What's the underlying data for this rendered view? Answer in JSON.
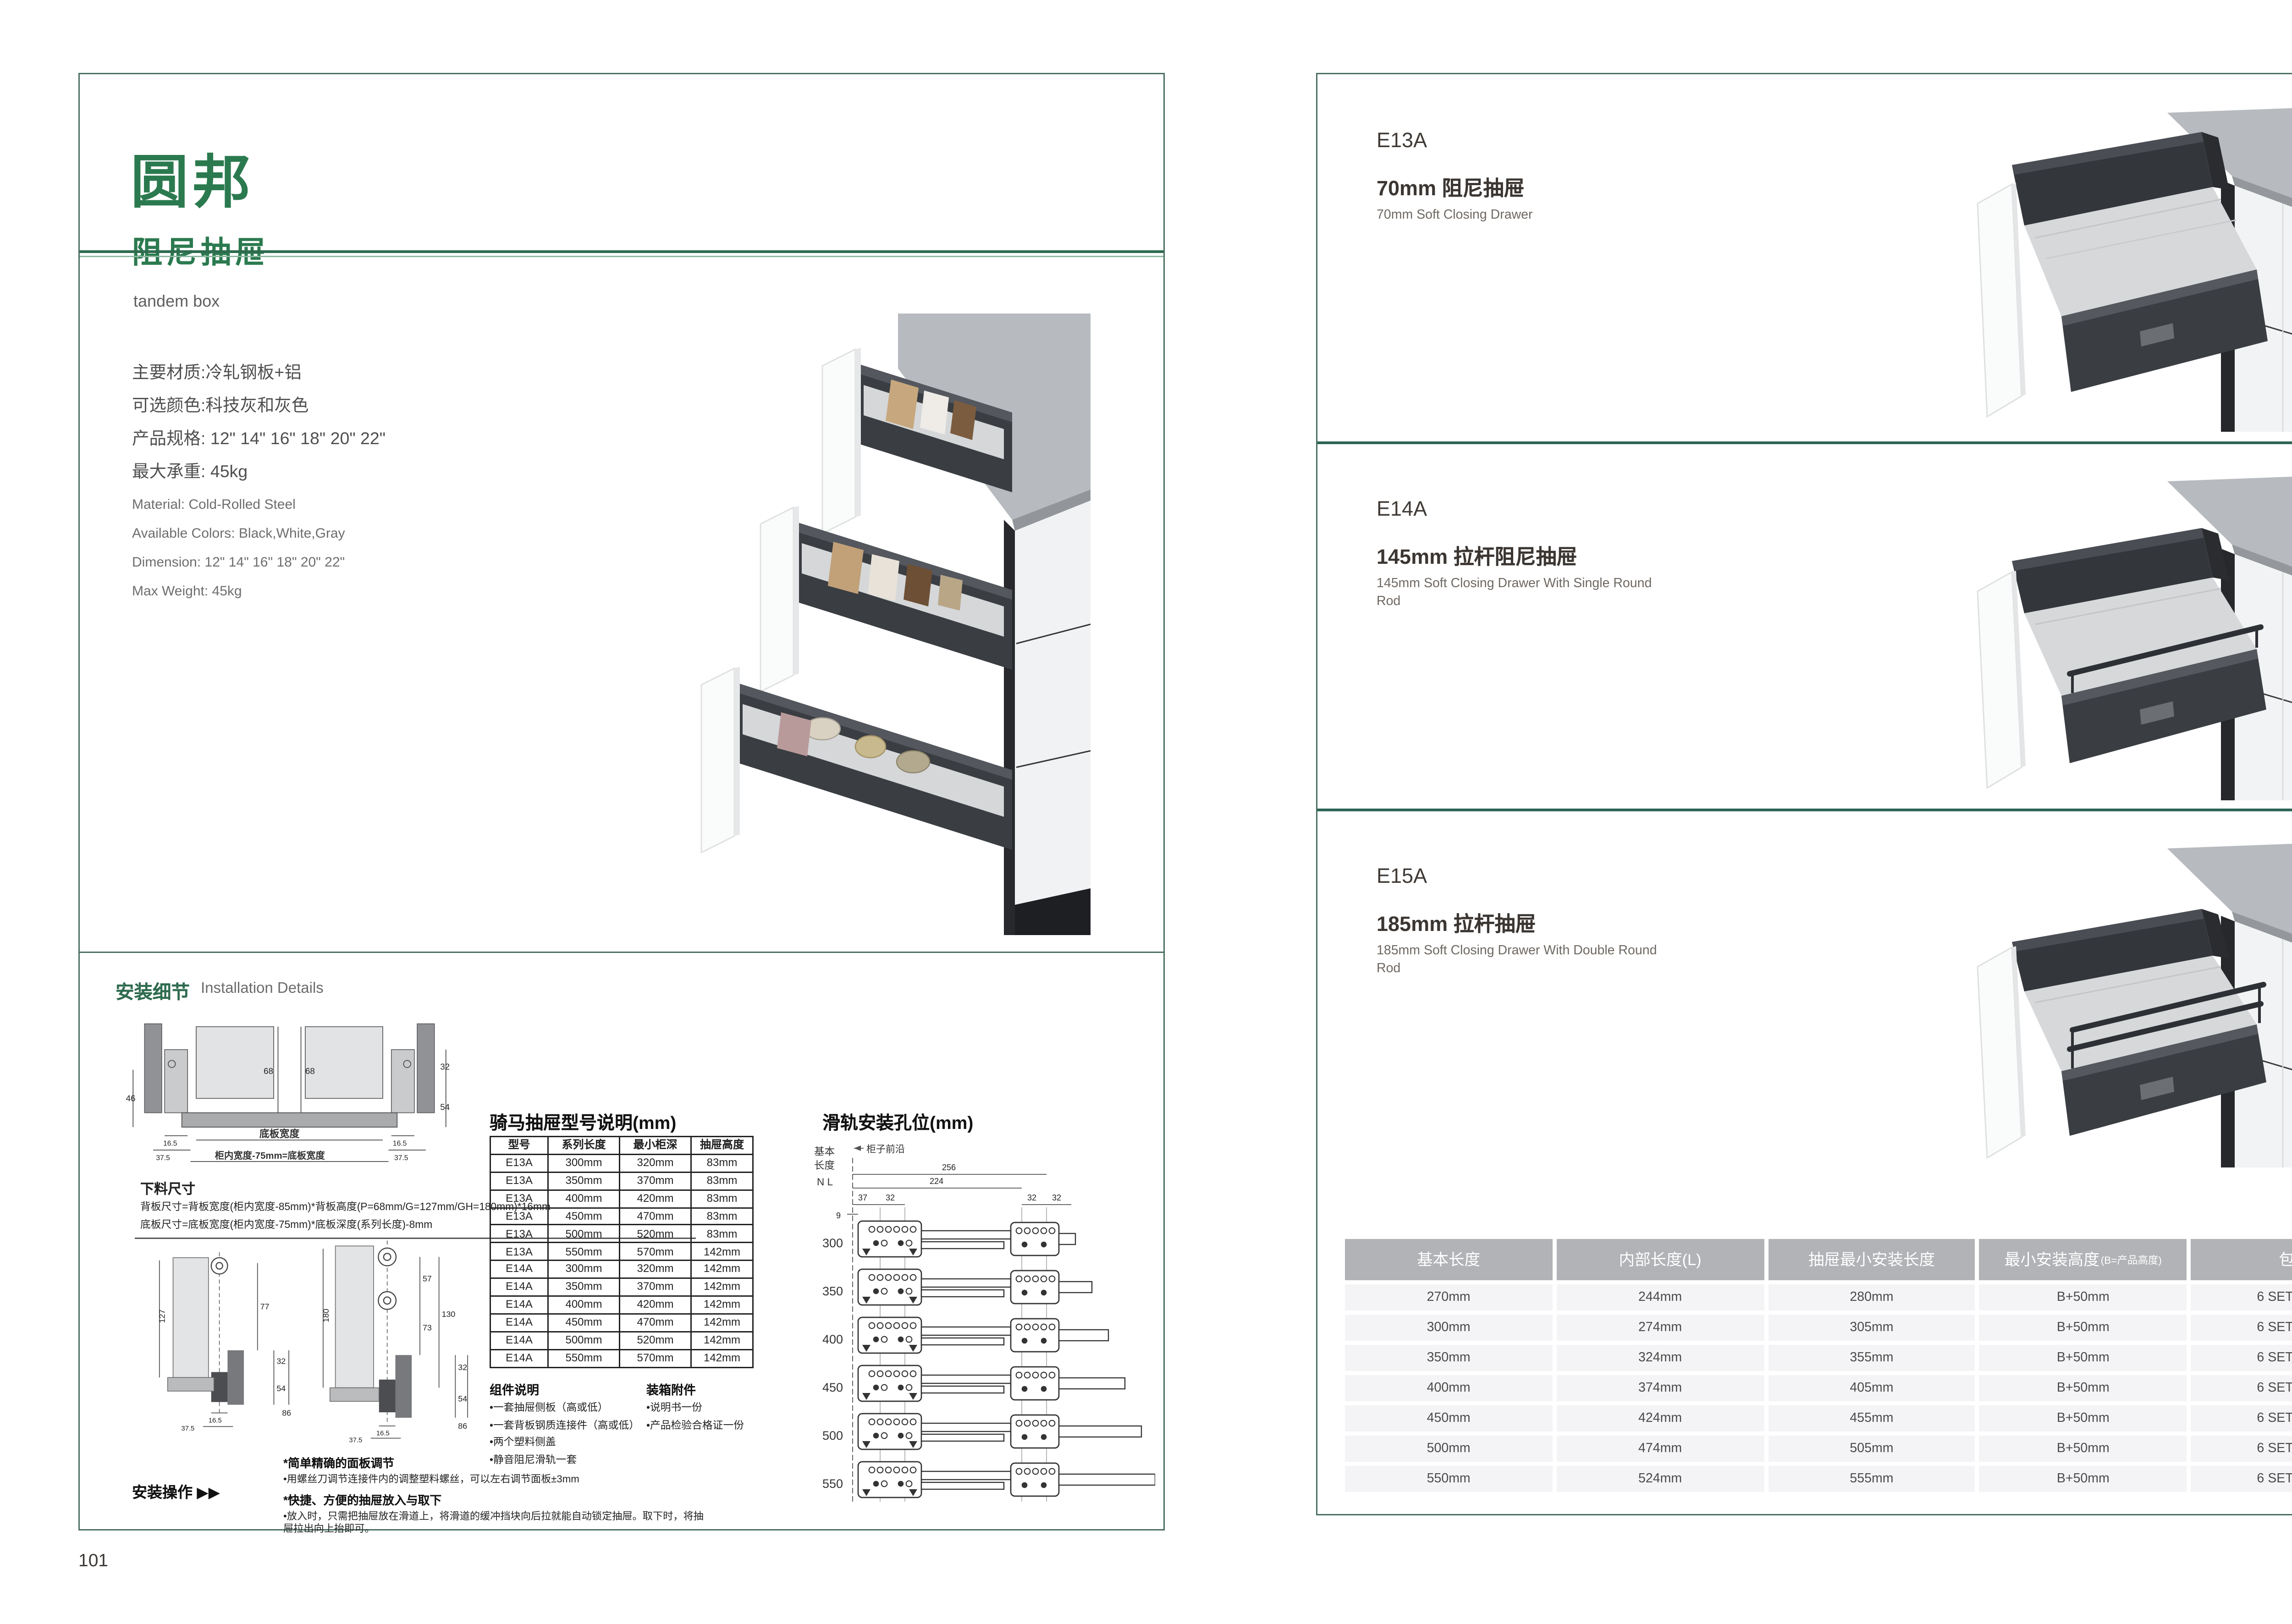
{
  "page": {
    "left_number": "101",
    "right_number": "102"
  },
  "left_page": {
    "brand": "圆邦",
    "subtitle_cn": "阻尼抽屉",
    "subtitle_en": "tandem box",
    "specs_cn": [
      "主要材质:冷轧钢板+铝",
      "可选颜色:科技灰和灰色",
      "产品规格: 12\" 14\" 16\" 18\" 20\" 22\"",
      "最大承重: 45kg"
    ],
    "specs_en": [
      "Material: Cold-Rolled Steel",
      "Available Colors: Black,White,Gray",
      "Dimension: 12\" 14\" 16\" 18\" 20\" 22\"",
      "Max Weight: 45kg"
    ],
    "install_title_cn": "安装细节",
    "install_title_en": "Installation Details",
    "cross_section": {
      "d68a": "68",
      "d68b": "68",
      "d46": "46",
      "d32": "32",
      "d54": "54",
      "d165l": "16.5",
      "d165r": "16.5",
      "d375l": "37.5",
      "d375r": "37.5",
      "label_width": "底板宽度",
      "label_formula": "柜内宽度-75mm=底板宽度"
    },
    "cutting": {
      "title": "下料尺寸",
      "formula1": "背板尺寸=背板宽度(柜内宽度-85mm)*背板高度(P=68mm/G=127mm/GH=180mm)*16mm",
      "formula2": "底板尺寸=底板宽度(柜内宽度-75mm)*底板深度(系列长度)-8mm"
    },
    "diagram_a": {
      "d127": "127",
      "d77": "77",
      "d32": "32",
      "d54": "54",
      "d86": "86",
      "d165": "16.5",
      "d375": "37.5"
    },
    "diagram_b": {
      "d180": "180",
      "d57": "57",
      "d73": "73",
      "d130": "130",
      "d32": "32",
      "d54": "54",
      "d86": "86",
      "d165": "16.5",
      "d375": "37.5"
    },
    "operation": {
      "label": "安装操作",
      "arrows": "▶▶",
      "note1_head": "*简单精确的面板调节",
      "note1_body": "•用螺丝刀调节连接件内的调整塑料螺丝，可以左右调节面板±3mm",
      "note2_head": "*快捷、方便的抽屉放入与取下",
      "note2_body": "•放入时，只需把抽屉放在滑道上，将滑道的缓冲挡块向后拉就能自动锁定抽屉。取下时，将抽屉拉出向上抬即可。"
    },
    "model_table": {
      "title": "骑马抽屉型号说明(mm)",
      "headers": [
        "型号",
        "系列长度",
        "最小柜深",
        "抽屉高度"
      ],
      "rows": [
        [
          "E13A",
          "300mm",
          "320mm",
          "83mm"
        ],
        [
          "E13A",
          "350mm",
          "370mm",
          "83mm"
        ],
        [
          "E13A",
          "400mm",
          "420mm",
          "83mm"
        ],
        [
          "E13A",
          "450mm",
          "470mm",
          "83mm"
        ],
        [
          "E13A",
          "500mm",
          "520mm",
          "83mm"
        ],
        [
          "E13A",
          "550mm",
          "570mm",
          "142mm"
        ],
        [
          "E14A",
          "300mm",
          "320mm",
          "142mm"
        ],
        [
          "E14A",
          "350mm",
          "370mm",
          "142mm"
        ],
        [
          "E14A",
          "400mm",
          "420mm",
          "142mm"
        ],
        [
          "E14A",
          "450mm",
          "470mm",
          "142mm"
        ],
        [
          "E14A",
          "500mm",
          "520mm",
          "142mm"
        ],
        [
          "E14A",
          "550mm",
          "570mm",
          "142mm"
        ]
      ]
    },
    "components": {
      "title": "组件说明",
      "items": [
        "•一套抽屉侧板（高或低）",
        "•一套背板钢质连接件（高或低）",
        "•两个塑料侧盖",
        "•静音阻尼滑轨一套"
      ]
    },
    "accessories": {
      "title": "装箱附件",
      "items": [
        "•说明书一份",
        "•产品检验合格证一份"
      ]
    },
    "rail_diagram": {
      "title": "滑轨安装孔位(mm)",
      "side1": "基本",
      "side2": "长度",
      "side3": "N L",
      "front_edge": "柜子前沿",
      "d256": "256",
      "d224": "224",
      "d37": "37",
      "d9": "9",
      "d32": "32",
      "lengths": [
        "300",
        "350",
        "400",
        "450",
        "500",
        "550"
      ]
    }
  },
  "right_page": {
    "products": [
      {
        "model": "E13A",
        "name_cn": "70mm 阻尼抽屉",
        "name_en": "70mm Soft Closing Drawer"
      },
      {
        "model": "E14A",
        "name_cn": "145mm 拉杆阻尼抽屉",
        "name_en": "145mm Soft Closing Drawer With Single Round Rod"
      },
      {
        "model": "E15A",
        "name_cn": "185mm 拉杆抽屉",
        "name_en": "185mm Soft Closing Drawer With Double Round Rod"
      }
    ],
    "size_table": {
      "headers": [
        "基本长度",
        "内部长度(L)",
        "抽屉最小安装长度",
        "最小安装高度",
        "包装"
      ],
      "header4_suffix": "(B=产品高度)",
      "rows": [
        [
          "270mm",
          "244mm",
          "280mm",
          "B+50mm",
          "6 SETC/TNB"
        ],
        [
          "300mm",
          "274mm",
          "305mm",
          "B+50mm",
          "6 SETC/TNB"
        ],
        [
          "350mm",
          "324mm",
          "355mm",
          "B+50mm",
          "6 SETC/TNB"
        ],
        [
          "400mm",
          "374mm",
          "405mm",
          "B+50mm",
          "6 SETC/TNB"
        ],
        [
          "450mm",
          "424mm",
          "455mm",
          "B+50mm",
          "6 SETC/TNB"
        ],
        [
          "500mm",
          "474mm",
          "505mm",
          "B+50mm",
          "6 SETC/TNB"
        ],
        [
          "550mm",
          "524mm",
          "555mm",
          "B+50mm",
          "6 SETC/TNB"
        ]
      ]
    }
  }
}
